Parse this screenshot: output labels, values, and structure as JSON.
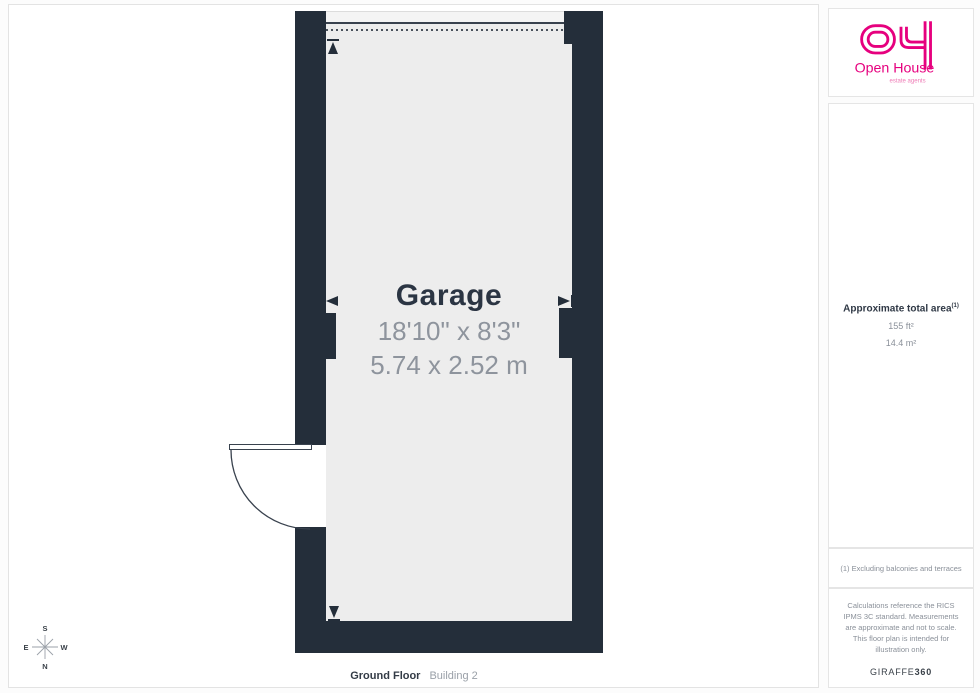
{
  "colors": {
    "wall": "#242e3a",
    "floor": "#ededed",
    "brand_pink": "#e6007e",
    "text_dark": "#2b3543",
    "text_gray": "#8e949d"
  },
  "plan": {
    "room": {
      "name": "Garage",
      "dimensions_imperial": "18'10\" x 8'3\"",
      "dimensions_metric": "5.74 x 2.52 m"
    },
    "floor_label": {
      "name": "Ground Floor",
      "building": "Building 2"
    },
    "compass": {
      "top": "S",
      "bottom": "N",
      "left": "E",
      "right": "W"
    }
  },
  "sidebar": {
    "logo": {
      "brand": "Open House",
      "tagline": "estate agents"
    },
    "area": {
      "title": "Approximate total area",
      "footnote_marker": "(1)",
      "imperial": "155 ft²",
      "metric": "14.4 m²"
    },
    "footnote": "(1) Excluding balconies and terraces",
    "disclaimer": "Calculations reference the RICS IPMS 3C standard. Measurements are approximate and not to scale. This floor plan is intended for illustration only.",
    "credit": {
      "brand": "GIRAFFE",
      "suffix": "360"
    }
  }
}
